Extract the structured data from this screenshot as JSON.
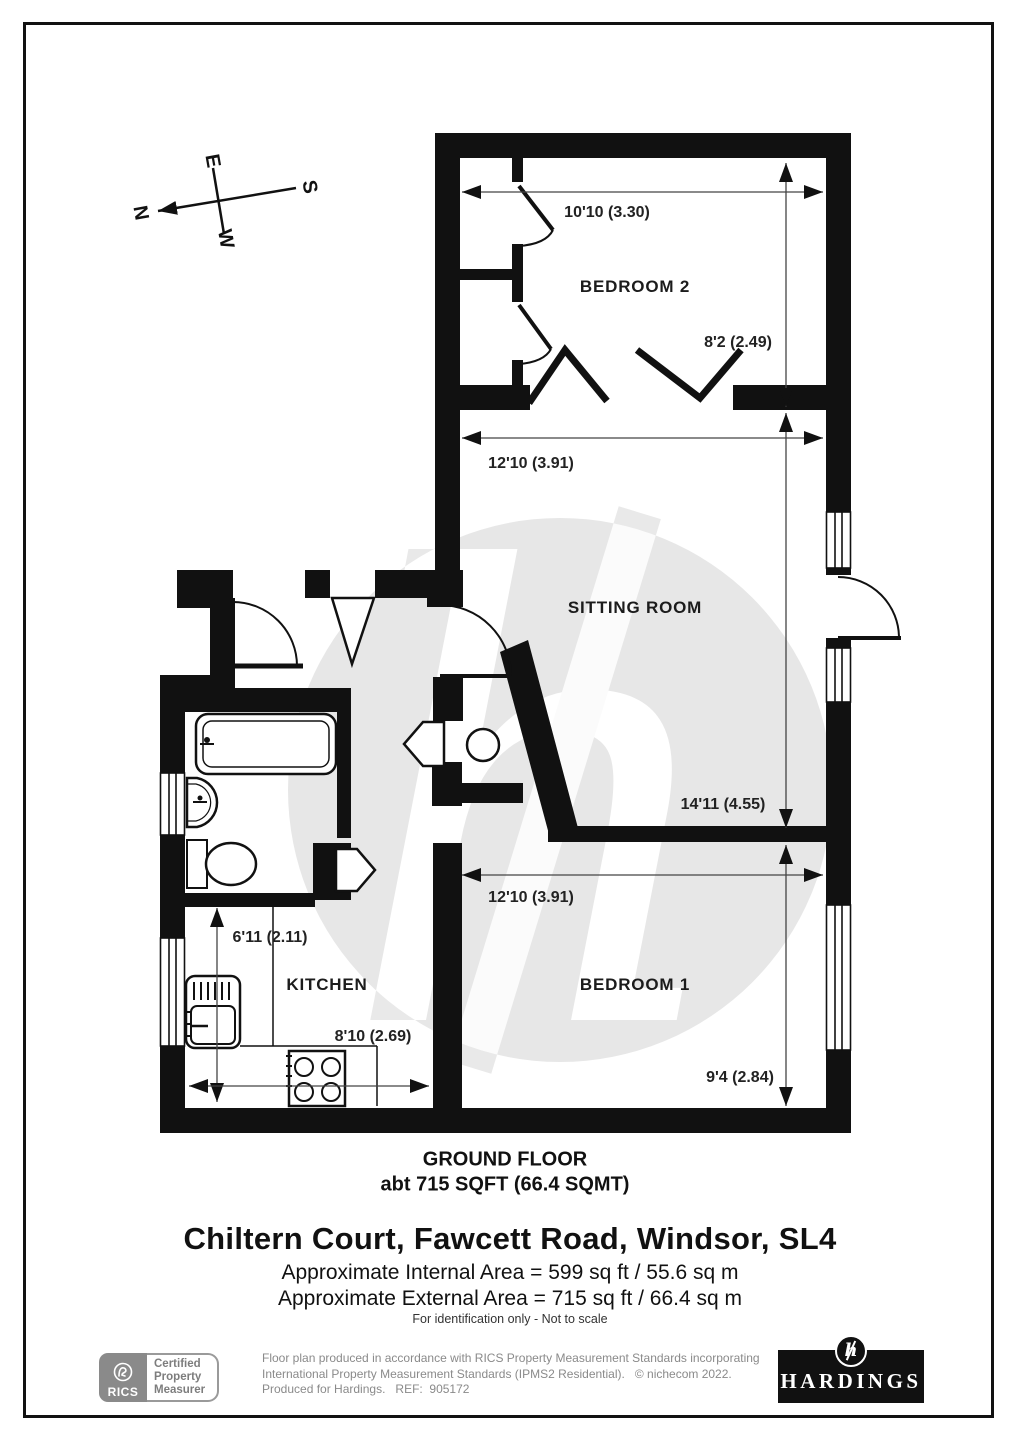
{
  "compass": {
    "north": "N",
    "east": "E",
    "south": "S",
    "west": "W"
  },
  "plan": {
    "rooms": [
      {
        "name": "BEDROOM 2"
      },
      {
        "name": "SITTING ROOM"
      },
      {
        "name": "BEDROOM 1"
      },
      {
        "name": "KITCHEN"
      }
    ],
    "dimensions": {
      "bedroom2": {
        "width": "10'10 (3.30)",
        "depth": "8'2 (2.49)"
      },
      "sitting_room": {
        "width": "12'10 (3.91)",
        "depth": "14'11 (4.55)"
      },
      "bedroom1": {
        "width": "12'10 (3.91)",
        "depth": "9'4 (2.84)"
      },
      "kitchen": {
        "depth": "6'11 (2.11)",
        "width": "8'10 (2.69)"
      }
    }
  },
  "floor_summary": {
    "title": "GROUND FLOOR",
    "area": "abt 715 SQFT (66.4 SQMT)"
  },
  "address": "Chiltern Court, Fawcett Road, Windsor, SL4",
  "internal_area": "Approximate Internal Area = 599 sq ft / 55.6 sq m",
  "external_area": "Approximate External Area = 715 sq ft / 66.4 sq m",
  "identification_note": "For identification only - Not to scale",
  "watermark": "h",
  "footer": {
    "rics": {
      "brand": "RICS",
      "certification": [
        "Certified",
        "Property",
        "Measurer"
      ]
    },
    "legal_lines": [
      "Floor plan produced in accordance with RICS Property Measurement Standards incorporating",
      "International Property Measurement Standards (IPMS2 Residential).   © nichecom 2022.",
      "Produced for Hardings.   REF:  905172"
    ],
    "hardings": {
      "name": "HARDINGS",
      "monogram": "h"
    }
  },
  "colors": {
    "wall": "#111111",
    "watermark_circle": "#e7e7e7",
    "watermark_glyph": "#ffffff",
    "footer_gray": "#8a8a8a"
  }
}
